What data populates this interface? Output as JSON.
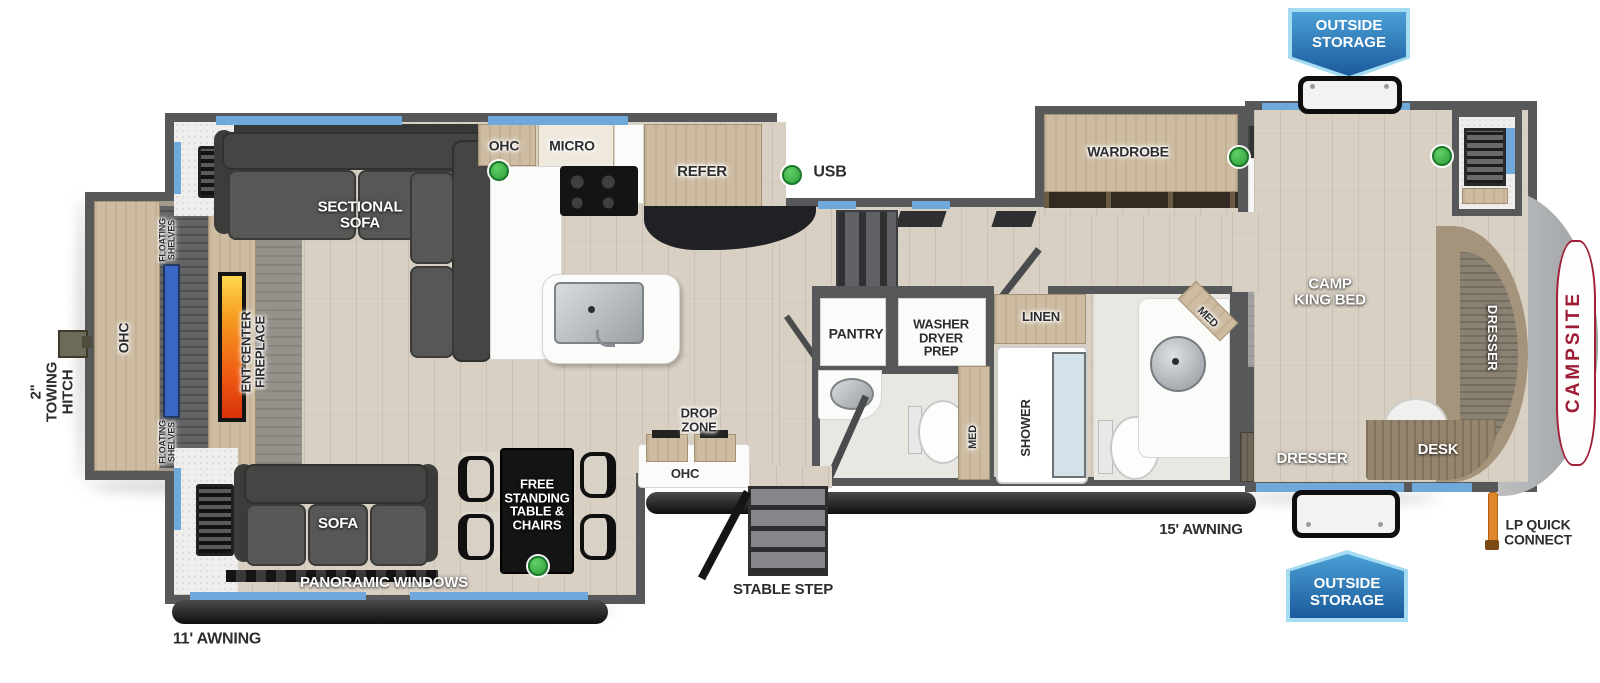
{
  "plan_name": "fifth wheel travel trailer floor plan",
  "badges": {
    "top": "OUTSIDE\nSTORAGE",
    "bottom": "OUTSIDE\nSTORAGE"
  },
  "legend": {
    "usb": "USB"
  },
  "exterior": {
    "towing_hitch": "2\"\nTOWING\nHITCH",
    "awning_left": "11' AWNING",
    "awning_right": "15' AWNING",
    "stable_step": "STABLE STEP",
    "lp_quick_connect": "LP QUICK\nCONNECT",
    "brand": "CAMPSITE"
  },
  "rear_living": {
    "ohc": "OHC",
    "floating_shelves_top": "FLOATING\nSHELVES",
    "floating_shelves_bottom": "FLOATING\nSHELVES",
    "ent_center": "ENT CENTER\nFIREPLACE",
    "sectional": "SECTIONAL\nSOFA",
    "sofa": "SOFA",
    "panoramic": "PANORAMIC WINDOWS",
    "dinette": "FREE\nSTANDING\nTABLE &\nCHAIRS"
  },
  "kitchen": {
    "ohc": "OHC",
    "micro": "MICRO",
    "refer": "REFER",
    "pantry": "PANTRY",
    "drop_zone": "DROP\nZONE",
    "drop_zone_ohc": "OHC"
  },
  "utility": {
    "washer_dryer": "WASHER\nDRYER\nPREP",
    "med_half_bath": "MED",
    "linen": "LINEN",
    "shower": "SHOWER",
    "med_main_bath": "MED"
  },
  "bedroom": {
    "wardrobe": "WARDROBE",
    "bed": "CAMP\nKING BED",
    "dresser_front": "DRESSER",
    "dresser_bottom": "DRESSER",
    "desk": "DESK"
  },
  "colors": {
    "wall": "#57585a",
    "floor": "#d8d0c3",
    "cabinet": "#cdbca2",
    "badge_blue": "#1b5a9b",
    "window_blue": "#6fa9dc",
    "usb_green": "#2f9e3c",
    "brand_red": "#9e1d35",
    "fireplace_orange": "#ef5a12"
  }
}
